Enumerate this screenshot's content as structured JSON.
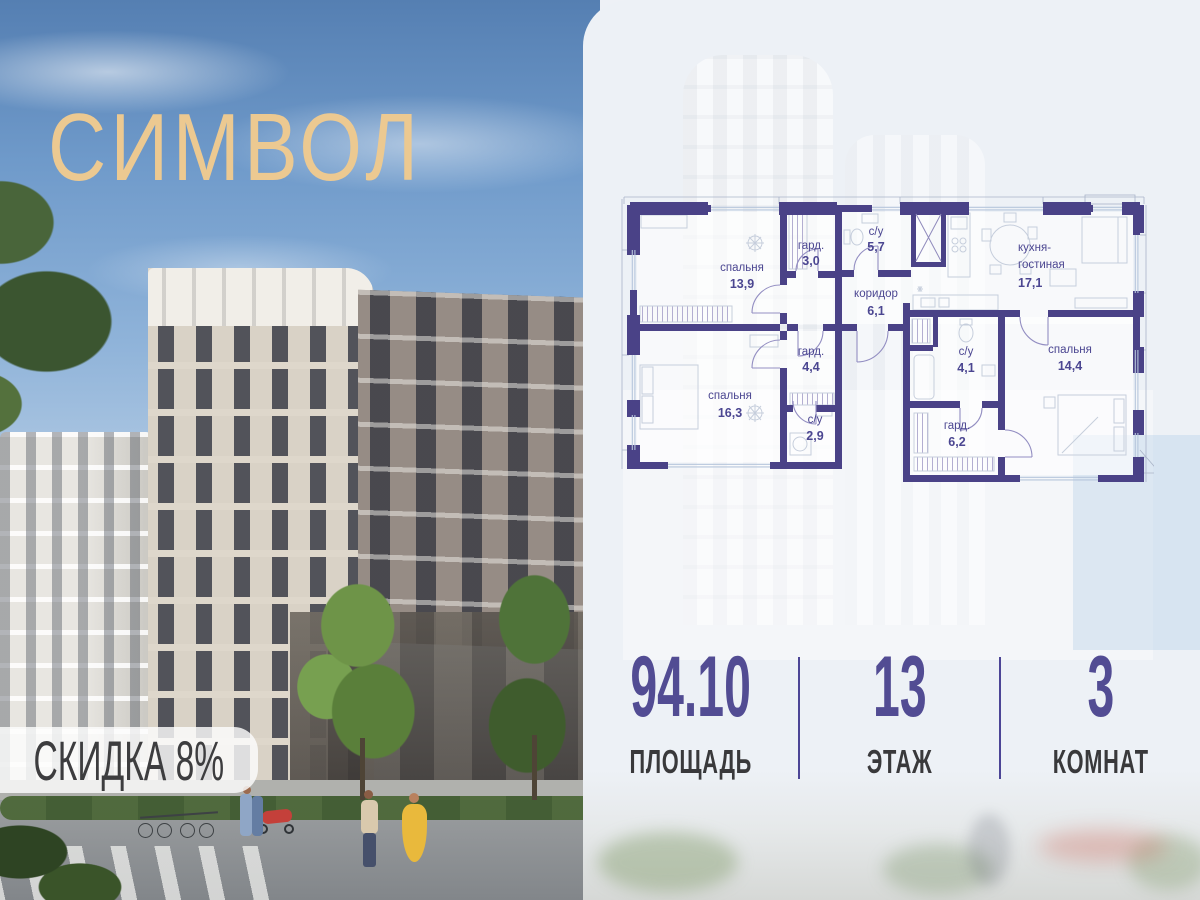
{
  "logo": {
    "text": "СИМВОЛ"
  },
  "badge": {
    "text": "СКИДКА 8%"
  },
  "plan": {
    "rooms": {
      "bedroom1": {
        "name": "спальня",
        "area": "13,9"
      },
      "wardrobe1": {
        "name": "гард.",
        "area": "3,0"
      },
      "bath1": {
        "name": "с/у",
        "area": "5,7"
      },
      "corridor": {
        "name": "коридор",
        "area": "6,1"
      },
      "kitchen": {
        "name_line1": "кухня-",
        "name_line2": "гостиная",
        "area": "17,1"
      },
      "wardrobe2": {
        "name": "гард.",
        "area": "4,4"
      },
      "bedroom2": {
        "name": "спальня",
        "area": "16,3"
      },
      "bath2": {
        "name": "с/у",
        "area": "2,9"
      },
      "bath3": {
        "name": "с/у",
        "area": "4,1"
      },
      "wardrobe3": {
        "name": "гард.",
        "area": "6,2"
      },
      "bedroom3": {
        "name": "спальня",
        "area": "14,4"
      }
    }
  },
  "stats": {
    "area": {
      "value": "94.10",
      "label": "ПЛОЩАДЬ"
    },
    "floor": {
      "value": "13",
      "label": "ЭТАЖ"
    },
    "rooms": {
      "value": "3",
      "label": "КОМНАТ"
    }
  },
  "colors": {
    "wall": "#4a4287",
    "accent_number": "#524c93",
    "logo_gold": "#ecc991",
    "badge_text": "#3d3d3f",
    "divider": "#4c4596"
  }
}
